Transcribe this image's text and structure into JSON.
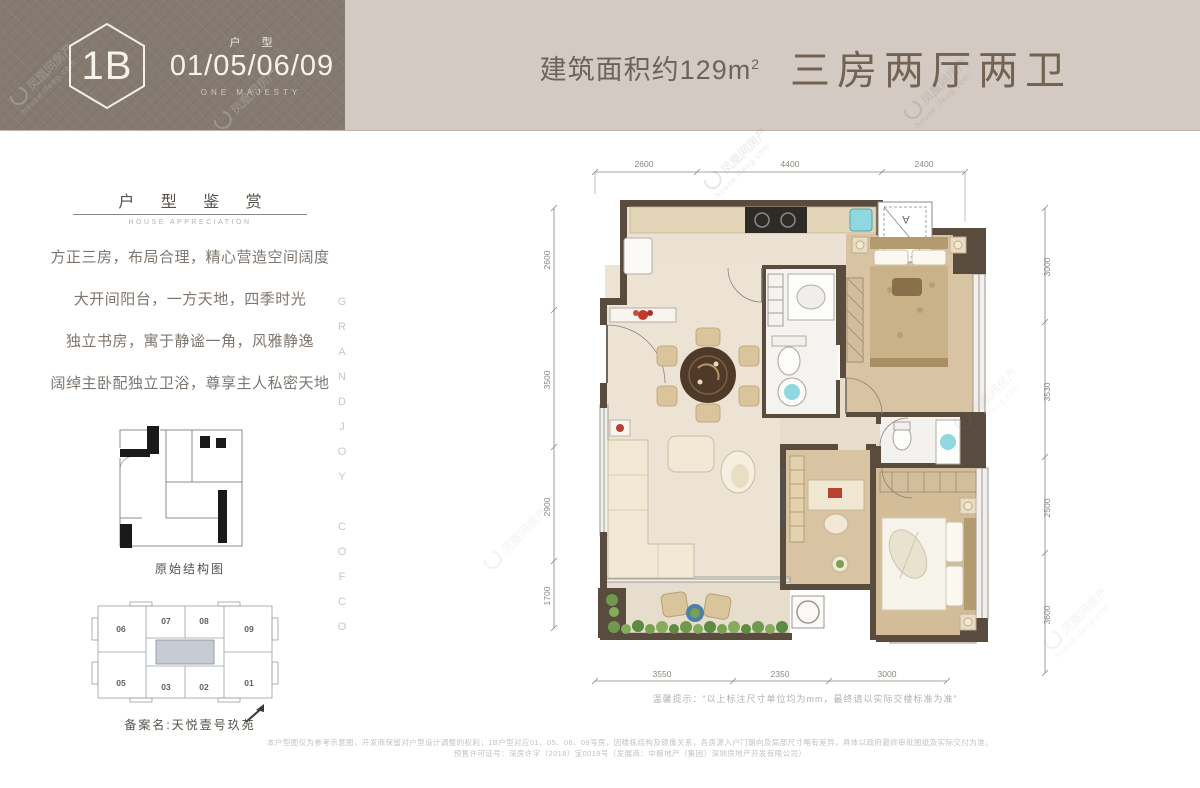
{
  "brand_watermark": {
    "name": "凤凰网房产",
    "url": "house.ifeng.com"
  },
  "header": {
    "unit_code": "1B",
    "type_label": "户 型",
    "unit_numbers": "01/05/06/09",
    "subtitle": "ONE MAJESTY",
    "area_text": "建筑面积约129m",
    "area_sup": "2",
    "layout_title": "三房两厅两卫"
  },
  "sidebar": {
    "section_title": "户 型 鉴 赏",
    "section_subtitle": "HOUSE APPRECIATION",
    "features": [
      "方正三房，布局合理，精心营造空间阔度",
      "大开间阳台，一方天地，四季时光",
      "独立书房，寓于静谧一角，风雅静逸",
      "阔绰主卧配独立卫浴，尊享主人私密天地"
    ],
    "structure_caption": "原始结构图",
    "keyplan": {
      "units_top": [
        "06",
        "07",
        "08",
        "09"
      ],
      "units_bottom": [
        "05",
        "03",
        "02",
        "01"
      ],
      "caption": "备案名:天悦壹号玖苑"
    },
    "vertical_brand": "GRANDJOY COFCO"
  },
  "floorplan": {
    "dims_top": [
      "2600",
      "4400",
      "2400"
    ],
    "dims_left": [
      "2600",
      "3500",
      "2900",
      "1700"
    ],
    "dims_right": [
      "3000",
      "3530",
      "2500",
      "3600"
    ],
    "dims_bottom": [
      "3550",
      "2350",
      "3000"
    ],
    "ac_letter_a": "A",
    "ac_letter_c": "C",
    "note": "温馨提示：“以上标注尺寸单位均为mm，最终请以实际交楼标准为准”"
  },
  "footer": {
    "disclaimer_line1": "本户型图仅为参考示意图，开发商保留对户型设计调整的权利；1B户型对应01、05、06、09号房，因楼栋结构及镜像关系，各房源入户门朝向及局部尺寸略有差异，具体以政府最终审批图纸及实际交付为准。",
    "disclaimer_line2": "预售许可证号：深房许字（2018）宝0019号（发展商：中粮地产（集团）深圳房地产开发有限公司）"
  },
  "colors": {
    "banner_dark": "#847a6f",
    "banner_light": "#d2cac3",
    "title_brown": "#746352",
    "wall": "#5a4b3f",
    "floor_cream": "#ebe2d4",
    "floor_wood": "#d8c3a2",
    "accent_cyan": "#8fd8df",
    "greenery": "#6f9a4e"
  }
}
